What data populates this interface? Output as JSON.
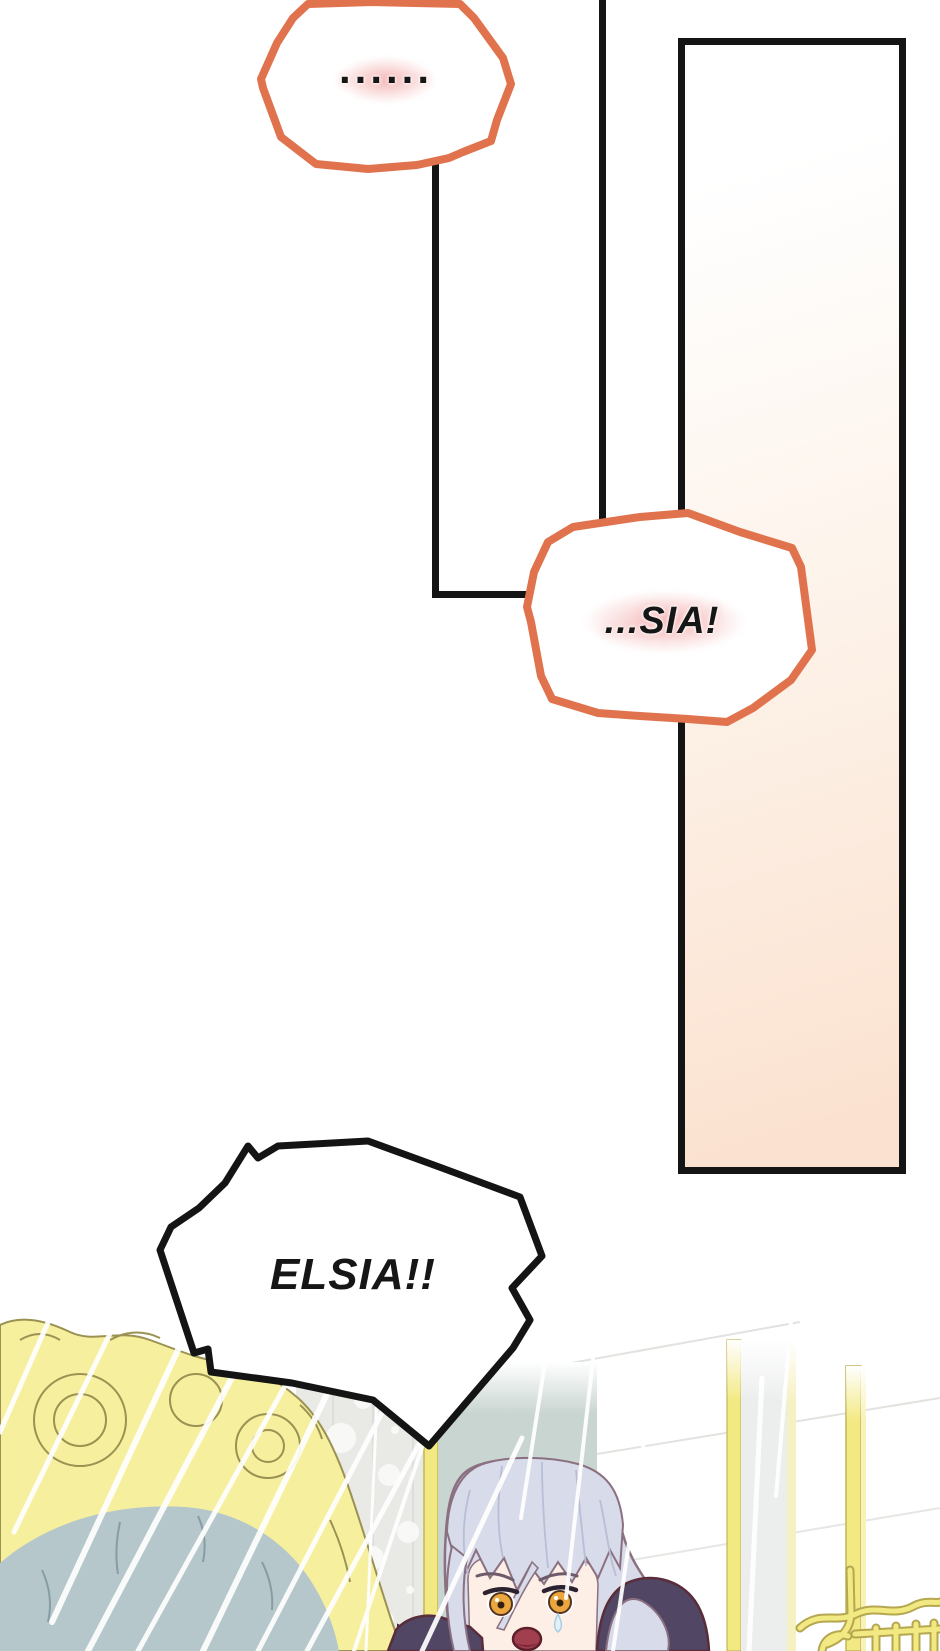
{
  "bubbles": {
    "silence": {
      "text": "......",
      "style": "soft-orange-outline",
      "glow": "pink"
    },
    "sia": {
      "text": "...SIA!",
      "style": "soft-orange-outline",
      "glow": "pink"
    },
    "elsia": {
      "text": "ELSIA!!",
      "style": "spiky-shout"
    }
  },
  "colors": {
    "accent_orange": "#e0734d",
    "glow_pink": "#f5b9b9",
    "ink_black": "#141414",
    "panel_peach": "#fbe2d0",
    "sofa_gold": "#f6f09e",
    "sofa_gold_line": "#9a9153",
    "cushion_blue": "#b5c7ca",
    "wallpaper_gray": "#e9eae6",
    "band_green_gray": "#c9d5d1",
    "band_gray": "#eceeed",
    "gold_bar": "#f3e982",
    "gold_edge": "#c2b557",
    "hair_base": "#d8dbe9",
    "hair_line": "#8a7080",
    "skin": "#fdeee6",
    "eye_amber": "#eca63e",
    "mouth_red": "#a23f4e",
    "clothing_purple": "#514663",
    "clothing_edge": "#5a2d3b"
  }
}
